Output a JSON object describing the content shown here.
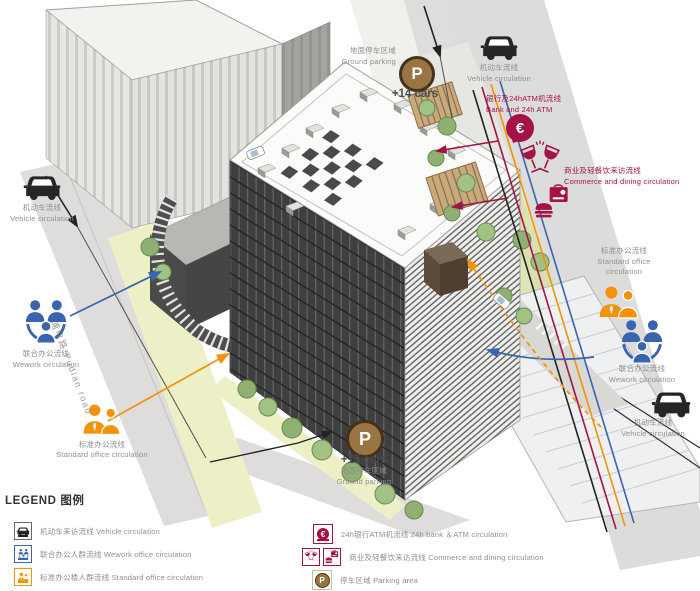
{
  "colors": {
    "crimson": "#a51245",
    "blue": "#3a64b0",
    "orange": "#f39207",
    "parking_brown": "#9a7544",
    "gray_text": "#8f8f8f"
  },
  "map": {
    "road_label": "浦电路 Pudian road",
    "left": {
      "vehicle": {
        "zh": "机动车流线",
        "en": "Vehicle circulation"
      },
      "wework": {
        "zh": "联合办公流线",
        "en": "Wework circulation"
      },
      "standard": {
        "zh": "标准办公流线",
        "en": "Standard office circulation"
      }
    },
    "top": {
      "parking": {
        "zh": "地面停车区域",
        "en": "Ground parking",
        "count": "+14 cars",
        "symbol": "P"
      },
      "vehicle": {
        "zh": "机动车流线",
        "en": "Vehicle circulation"
      },
      "bank": {
        "zh": "银行及24hATM机流线",
        "en": "Bank and 24h ATM",
        "symbol": "€"
      },
      "commerce": {
        "zh": "商业及轻餐饮来访流线",
        "en": "Commerce and dining circulation"
      }
    },
    "right": {
      "standard": {
        "zh": "标准办公流线",
        "en": "Standard office circulation"
      },
      "wework": {
        "zh": "联合办公流线",
        "en": "Wework circulation"
      },
      "vehicle": {
        "zh": "机动车流线",
        "en": "Vehicle circulation"
      }
    },
    "bottom": {
      "parking": {
        "zh": "地面停车区域",
        "en": "Ground parking",
        "count": "+15 cars",
        "symbol": "P"
      }
    }
  },
  "legend": {
    "title": "LEGEND 图例",
    "left": [
      {
        "label": "机动车来访流线 Vehicle circulation"
      },
      {
        "label": "联合办公人群流线 Wework office circulation"
      },
      {
        "label": "标准办公楼人群流线 Standard office circulation"
      }
    ],
    "right": [
      {
        "label": "24h银行ATM机流线 24h bank ＆ATM circulation",
        "symbol": "€"
      },
      {
        "label": "商业及轻餐饮来访流线 Commerce and dining circulation"
      },
      {
        "label": "停车区域 Parking area",
        "symbol": "P"
      }
    ]
  }
}
